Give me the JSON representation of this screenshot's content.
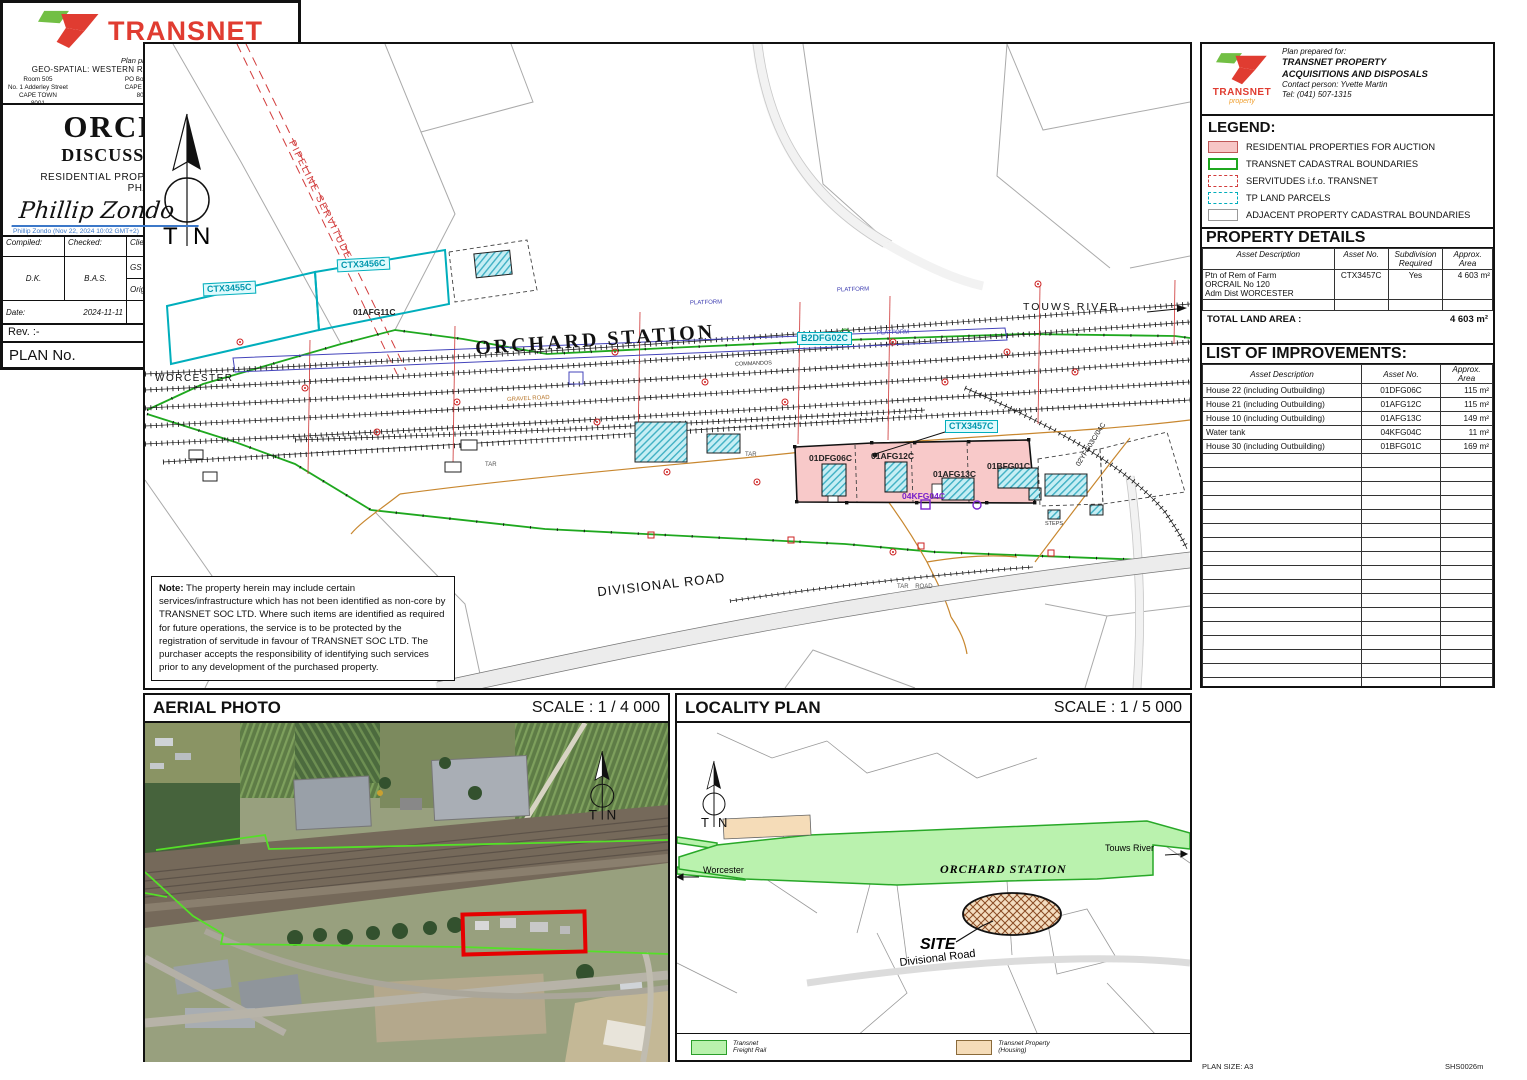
{
  "colors": {
    "transnet_red": "#e03c31",
    "logo_green": "#72bf44",
    "auction_pink": "#f8c9c9",
    "boundary_green": "#1fa81f",
    "tp_cyan": "#00aebc",
    "servitude_red": "#d23c3c",
    "signature_blue": "#3c78c8"
  },
  "prepared_for": {
    "brand": "TRANSNET",
    "brand_sub": "property",
    "line1": "Plan prepared for:",
    "line2": "TRANSNET PROPERTY",
    "line3": "ACQUISITIONS AND DISPOSALS",
    "line4": "Contact person: Yvette Martin",
    "line5": "Tel: (041) 507-1315"
  },
  "legend": {
    "title": "LEGEND:",
    "items": [
      "RESIDENTIAL PROPERTIES FOR AUCTION",
      "TRANSNET CADASTRAL BOUNDARIES",
      "SERVITUDES i.f.o. TRANSNET",
      "TP LAND PARCELS",
      "ADJACENT PROPERTY CADASTRAL BOUNDARIES"
    ]
  },
  "property_details": {
    "title": "PROPERTY DETAILS",
    "headers": [
      "Asset Description",
      "Asset No.",
      "Subdivision\nRequired",
      "Approx.\nArea"
    ],
    "rows": [
      {
        "desc": "Ptn of Rem of Farm\nORCRAIL No 120\nAdm Dist WORCESTER",
        "asset_no": "CTX3457C",
        "subdivision": "Yes",
        "area": "4 603 m²"
      }
    ],
    "total_label": "TOTAL LAND AREA :",
    "total_value": "4 603 m²"
  },
  "improvements": {
    "title": "LIST OF IMPROVEMENTS:",
    "headers": [
      "Asset Description",
      "Asset No.",
      "Approx. Area"
    ],
    "rows": [
      {
        "desc": "House 22 (including Outbuilding)",
        "asset_no": "01DFG06C",
        "area": "115 m²"
      },
      {
        "desc": "House 21 (including Outbuilding)",
        "asset_no": "01AFG12C",
        "area": "115 m²"
      },
      {
        "desc": "House 10 (including Outbuilding)",
        "asset_no": "01AFG13C",
        "area": "149 m²"
      },
      {
        "desc": "Water tank",
        "asset_no": "04KFG04C",
        "area": "11 m²"
      },
      {
        "desc": "House 30 (including Outbuilding)",
        "asset_no": "01BFG01C",
        "area": "169 m²"
      }
    ]
  },
  "map": {
    "labels": {
      "pipeline_servitude": "PIPELINE SERVITUDE",
      "worcester": "WORCESTER",
      "touws_river": "TOUWS RIVER",
      "orchard_station": "ORCHARD STATION",
      "divisional_road": "DIVISIONAL ROAD",
      "ctx3455c": "CTX3455C",
      "ctx3456c": "CTX3456C",
      "afg11c": "01AFG11C",
      "b2dfg02c": "B2DFG02C",
      "ctx3457c": "CTX3457C",
      "dfg06c": "01DFG06C",
      "afg12c": "01AFG12C",
      "afg13c": "01AFG13C",
      "bfg01c": "01BFG01C",
      "kfg04c": "04KFG04C",
      "yfg": "02YFG03C/04C",
      "platform": "PLATFORM",
      "tar": "TAR",
      "tar_road": "TAR    ROAD",
      "gravel_road": "GRAVEL ROAD",
      "commandos": "COMMANDOS",
      "steps": "STEPS"
    },
    "compass": {
      "t": "T",
      "n": "N"
    },
    "note_title": "Note:",
    "note_body": "The property herein may include certain services/infrastructure which has not been identified as non-core by TRANSNET SOC LTD. Where such items are identified as required for future operations, the service is to be protected by the registration of servitude in favour of TRANSNET SOC LTD. The purchaser accepts the responsibility of identifying such services prior to any development of the purchased property."
  },
  "aerial": {
    "title": "AERIAL PHOTO",
    "scale": "SCALE : 1 / 4 000"
  },
  "locality": {
    "title": "LOCALITY PLAN",
    "scale": "SCALE : 1 / 5 000",
    "labels": {
      "worcester": "Worcester",
      "touws_river": "Touws River",
      "station": "ORCHARD STATION",
      "site": "SITE",
      "road": "Divisional Road"
    },
    "legend": [
      {
        "label": "Transnet\nFreight Rail"
      },
      {
        "label": "Transnet Property\n(Housing)"
      }
    ]
  },
  "title_block": {
    "brand": "TRANSNET",
    "prepared_by": "Plan prepared by:",
    "dept": "GEO-SPATIAL: WESTERN REGION, TRANSNET PROPERTY",
    "addr1": "Room 505\nNo. 1 Adderley Street\nCAPE TOWN\n8001",
    "addr2": "PO Box 5527\nCAPE TOWN\n8000",
    "addr3": "Tel: (021) 449-4484\nTel: (021) 449-4357\ncptenquiries@transnet.net",
    "title": "ORCHARD",
    "subtitle": "DISCUSSION PLAN",
    "subject1": "RESIDENTIAL PROPERTIES FOR AUCTION",
    "subject2": "PHASE 1",
    "signature": "Phillip Zondo",
    "signature_meta": "Phillip Zondo (Nov 22, 2024 10:02 GMT+2)",
    "compiled_label": "Compiled:",
    "checked_label": "Checked:",
    "compiled": "D.K.",
    "checked": "B.A.S.",
    "client_ref_label": "Client File Ref.:",
    "gs_ref_label": "GS File Ref.:",
    "orig_ref_label": "Original Ref.:",
    "orig_ref": "3218DA; ODR",
    "date_label": "Date:",
    "date": "2024-11-11",
    "scale": "SCALE : 1 / 2 000",
    "rev": "Rev. :-",
    "plan_no_label": "PLAN No.",
    "plan_no": "ODR 0013m"
  },
  "sheet": {
    "plan_size": "PLAN SIZE: A3",
    "sheet_code": "SHS0026m"
  }
}
